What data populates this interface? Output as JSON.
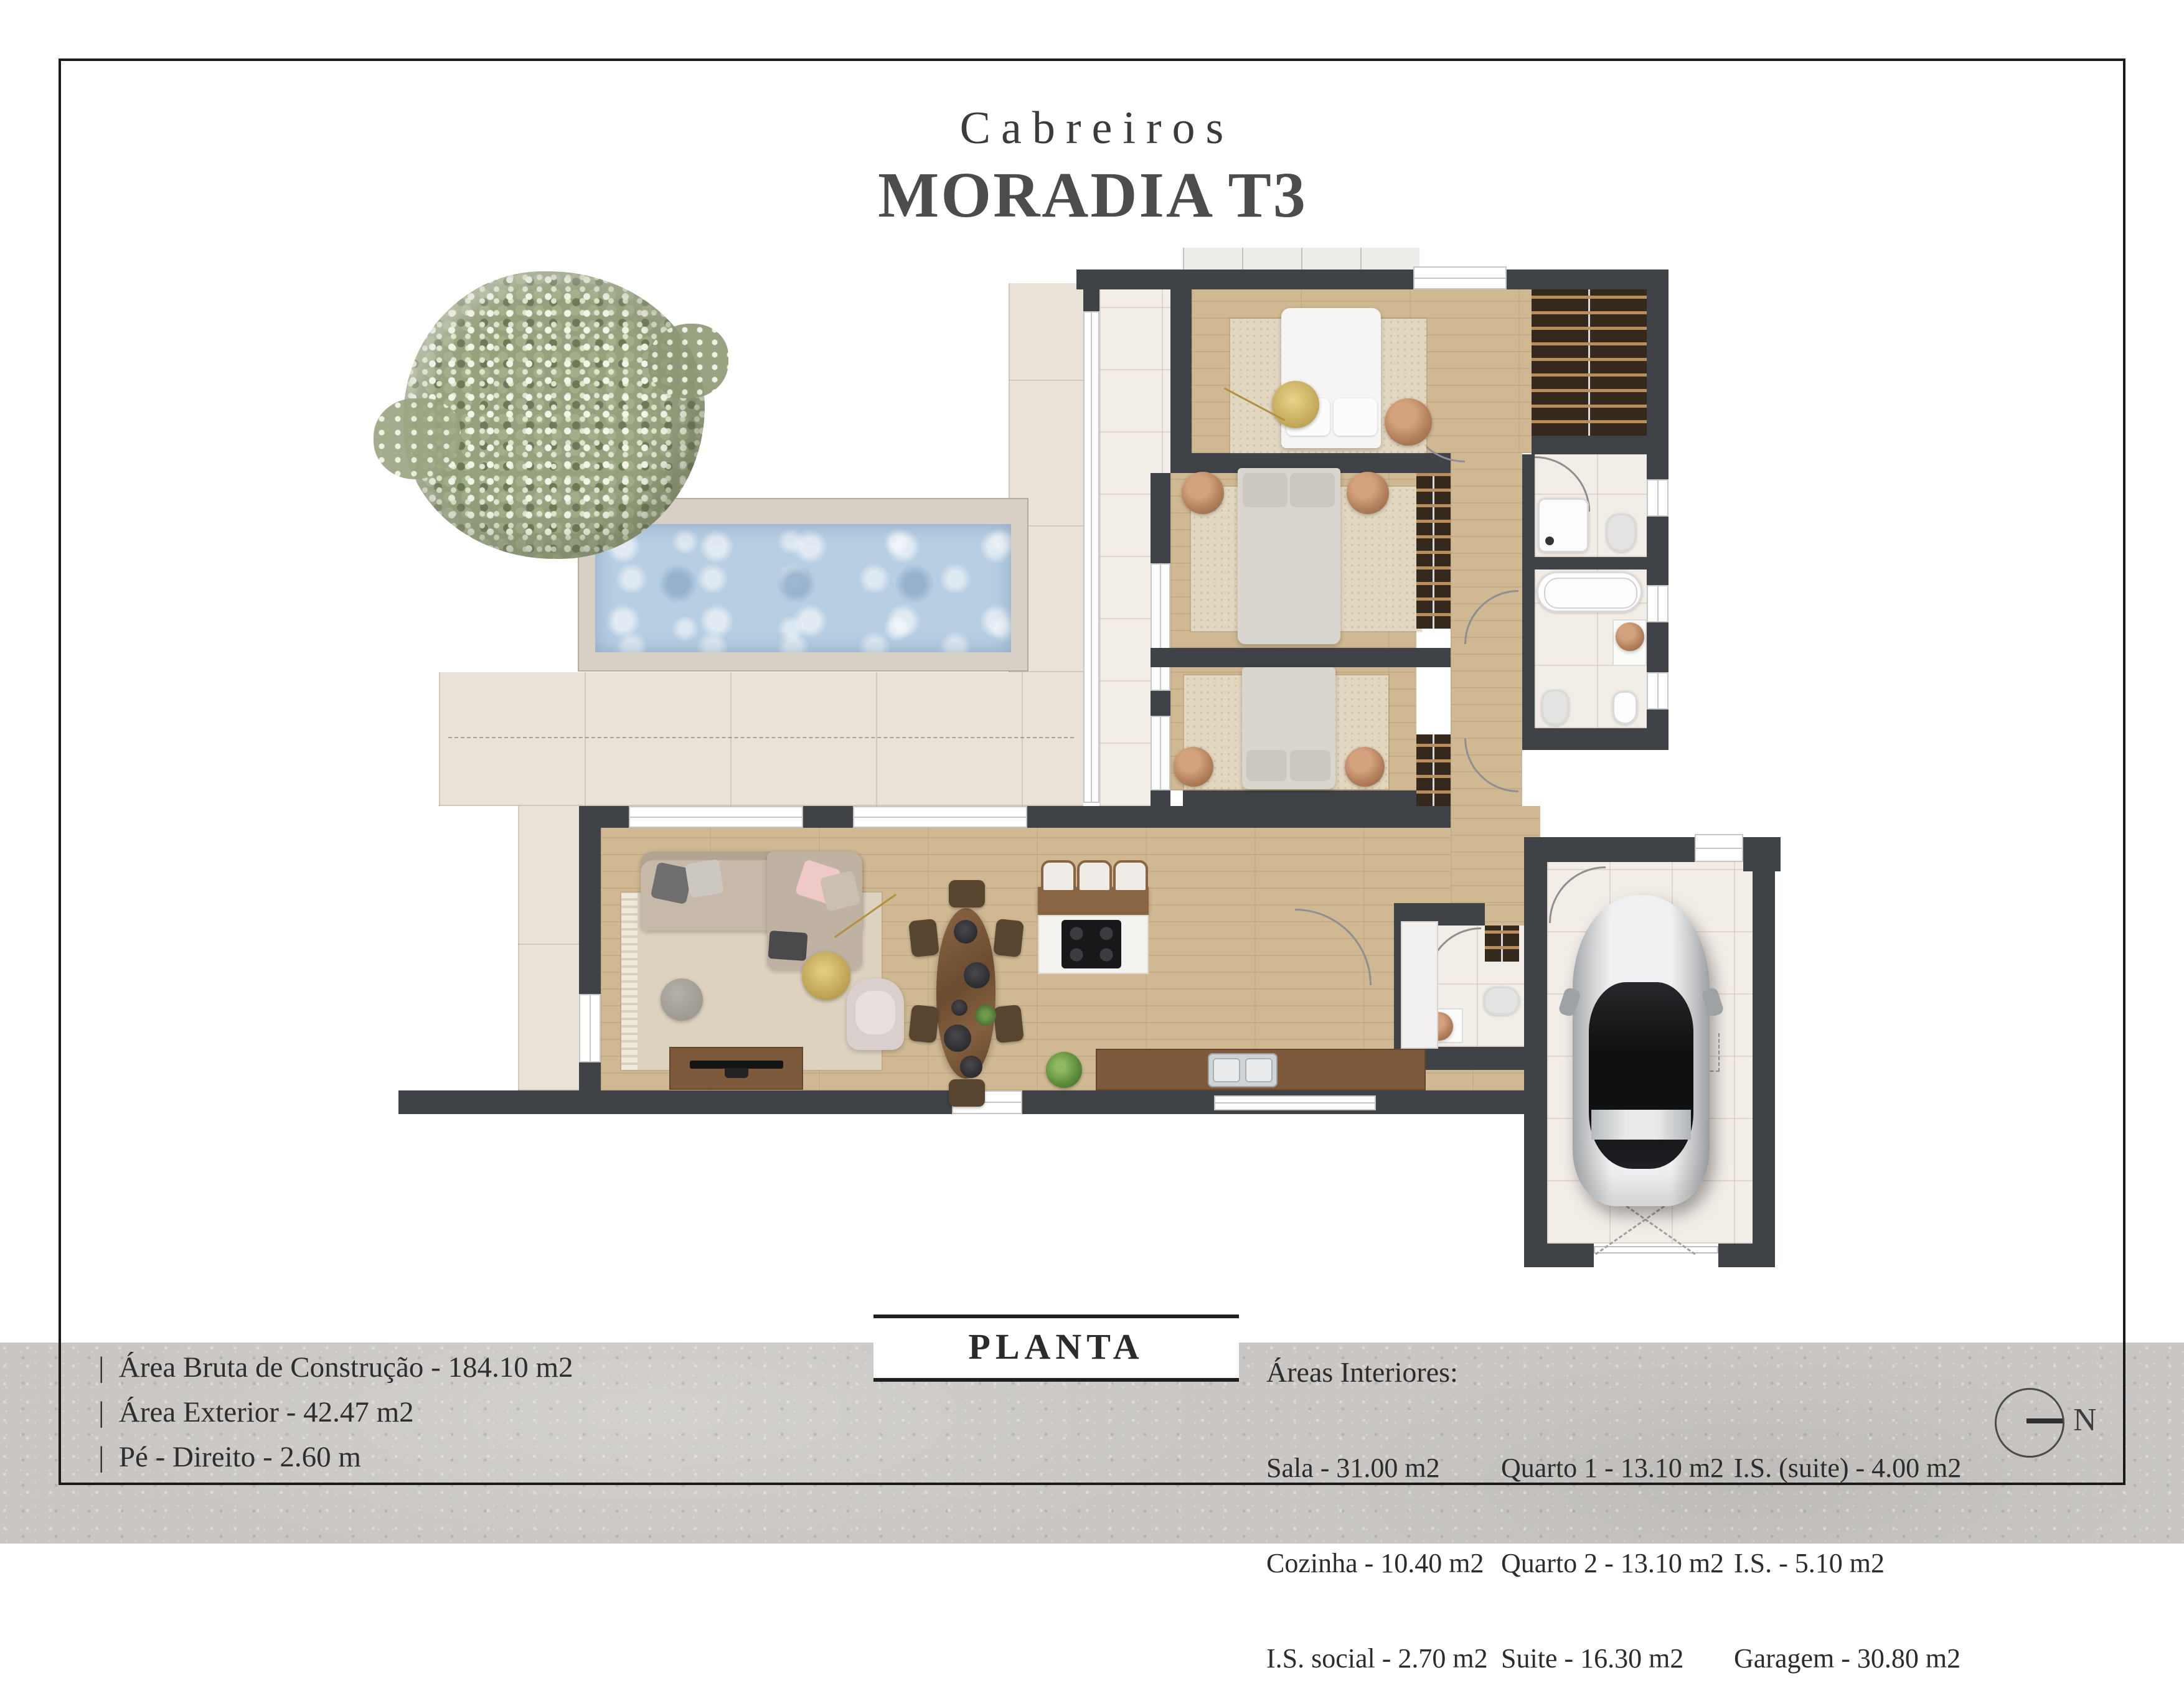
{
  "title": {
    "brand": "Cabreiros",
    "name": "MORADIA T3"
  },
  "plan_label": {
    "label": "PLANTA"
  },
  "footer": {
    "specs": [
      "|  Área Bruta de Construção - 184.10 m2",
      "|  Área Exterior - 42.47 m2",
      "|  Pé - Direito - 2.60 m"
    ],
    "areas": {
      "header": "Áreas Interiores:",
      "col1": [
        "Sala - 31.00 m2",
        "Cozinha - 10.40 m2",
        "I.S. social - 2.70 m2"
      ],
      "col2": [
        "Quarto 1 - 13.10 m2",
        "Quarto 2 - 13.10 m2",
        "Suite - 16.30 m2"
      ],
      "col3": [
        "I.S. (suite) - 4.00 m2",
        "I.S. - 5.10 m2",
        "Garagem - 30.80 m2"
      ]
    },
    "compass": {
      "label": "N"
    }
  },
  "colors": {
    "frame": "#1a1a1a",
    "wall": "#3f4347",
    "wood_floor": "#cfb892",
    "tile_floor": "#f3ede8",
    "terrace": "#eae2d8",
    "pool_water": "#b7cee3",
    "pool_deck": "#d9d0c5",
    "furniture_wood": "#7d5a3b",
    "wardrobe": "#36291d",
    "car_silver": "#dfe1e3",
    "tree_green": "#93a07c",
    "footer_band": "#c9c6c3"
  }
}
